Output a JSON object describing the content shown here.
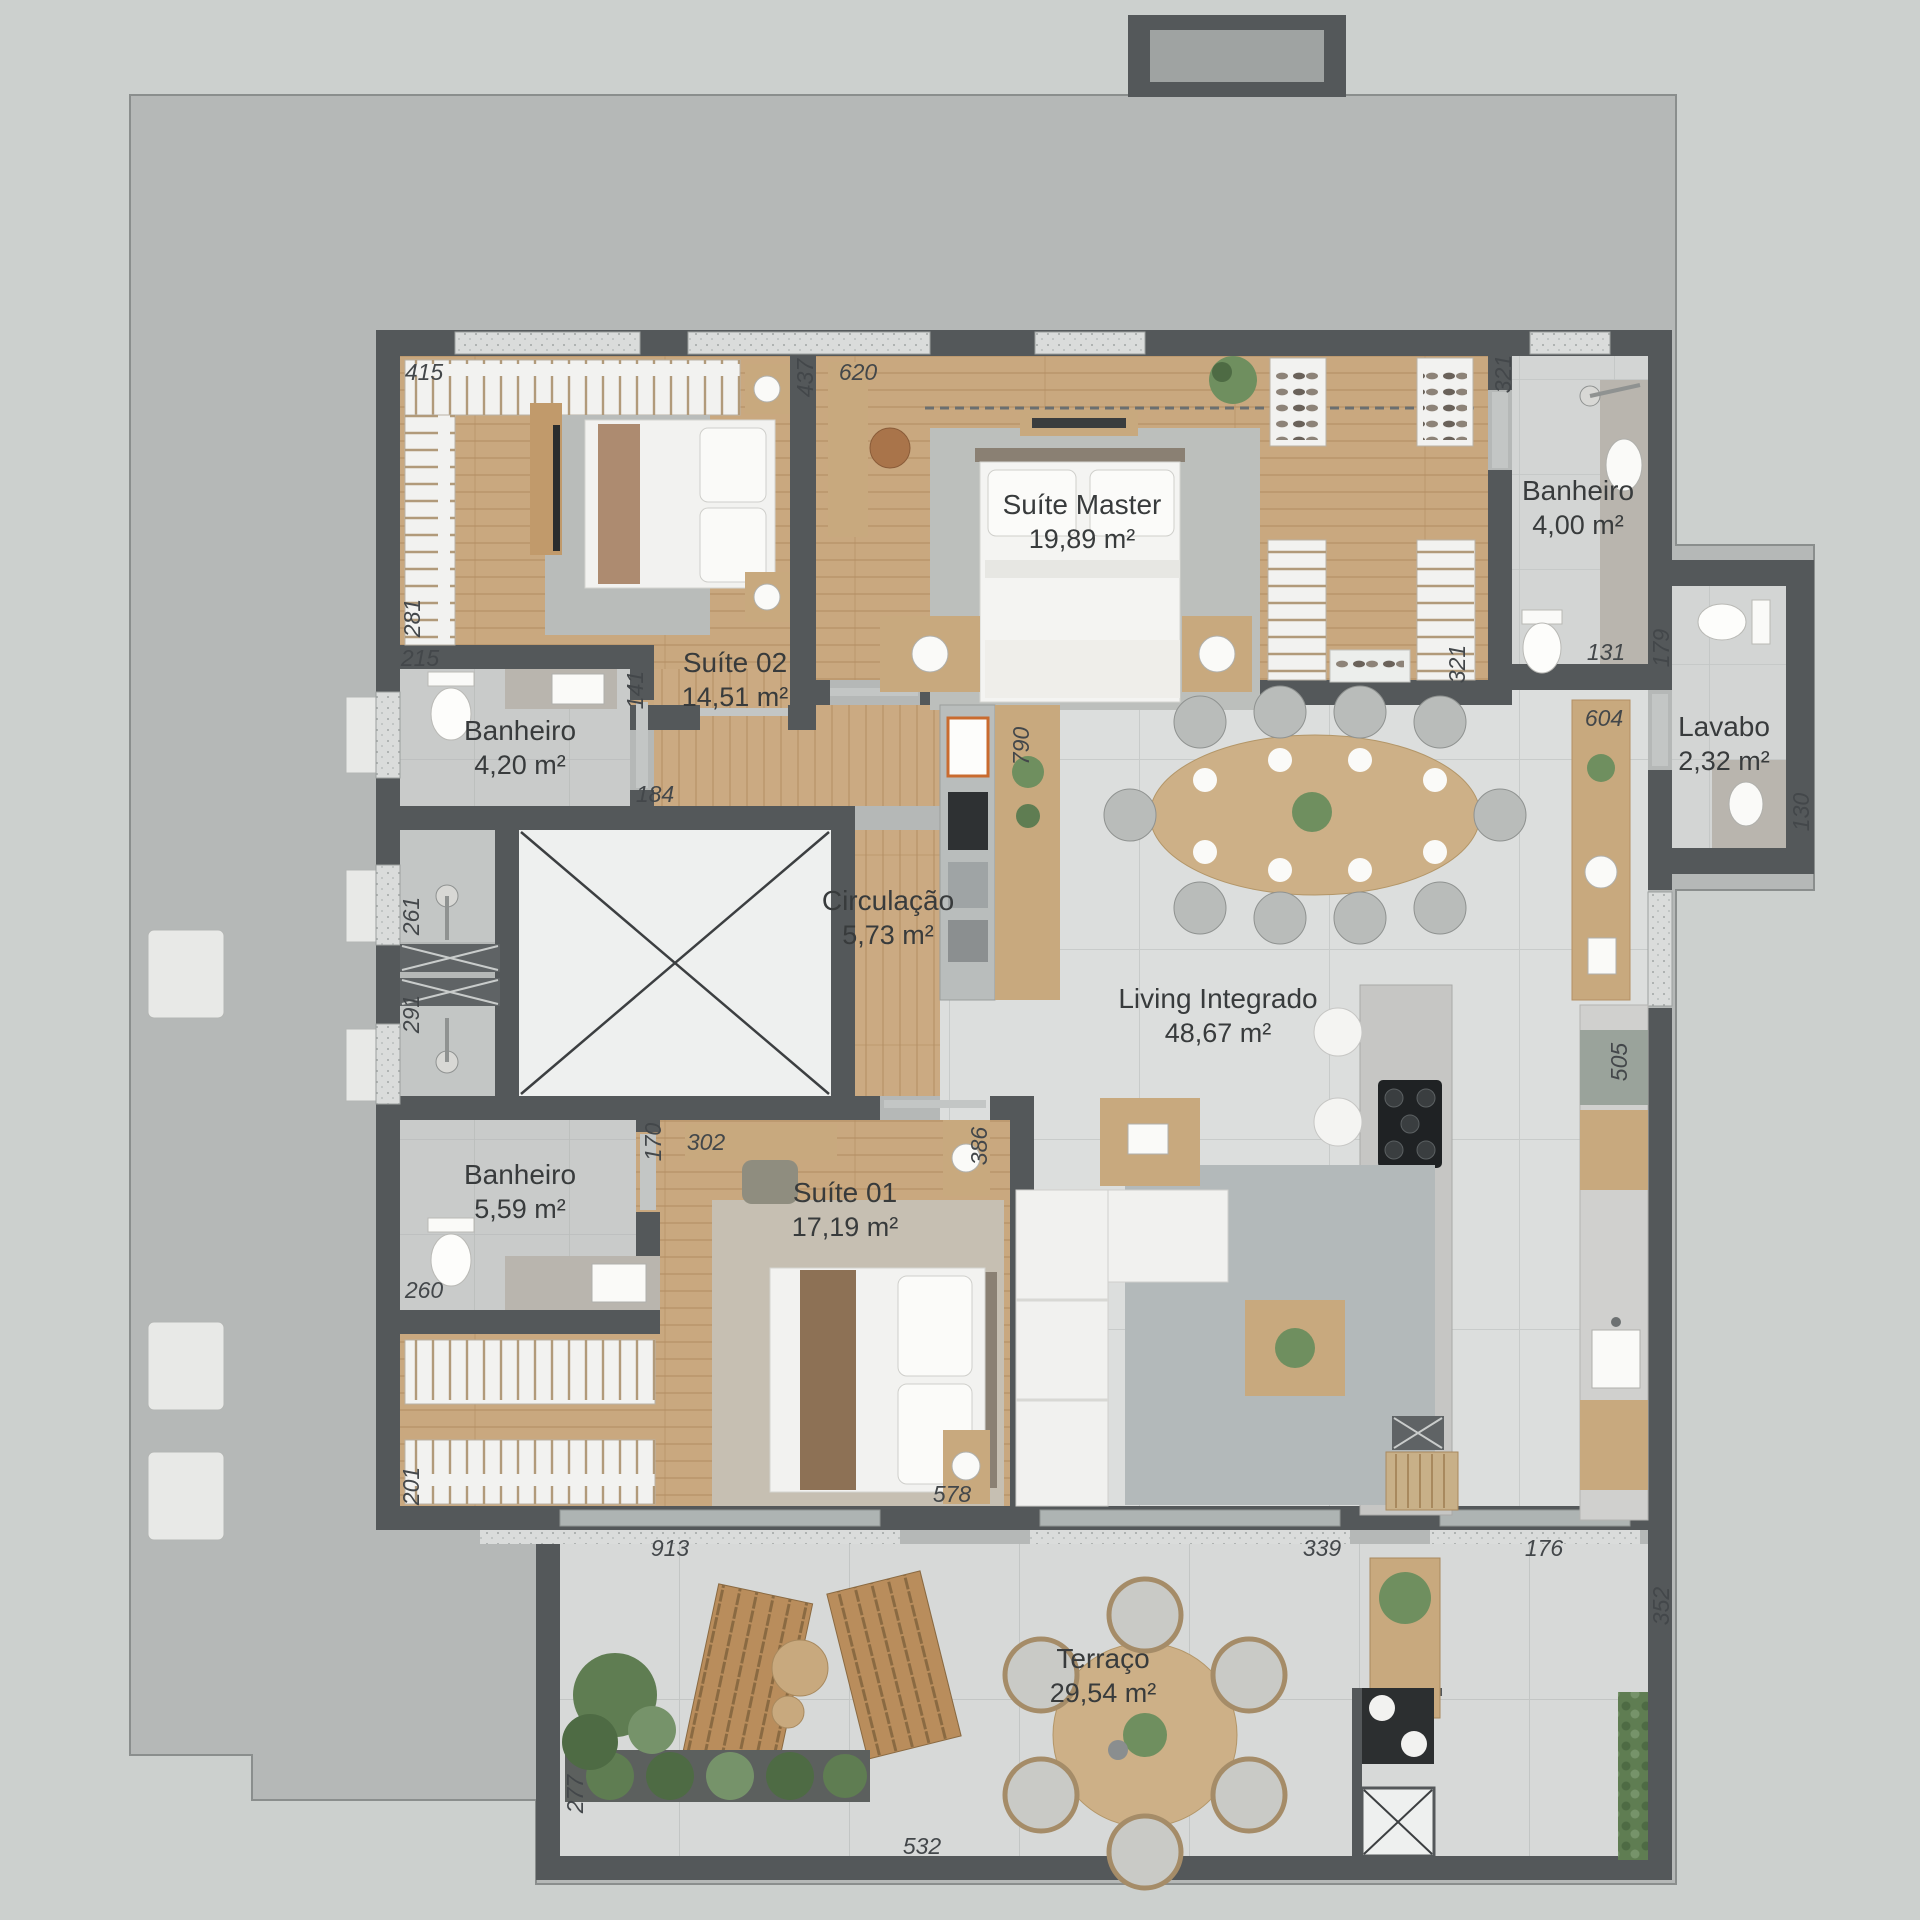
{
  "plan": {
    "rooms": {
      "suite02": {
        "name": "Suíte 02",
        "area": "14,51 m²"
      },
      "suiteMaster": {
        "name": "Suíte Master",
        "area": "19,89 m²"
      },
      "banheiroMaster": {
        "name": "Banheiro",
        "area": "4,00 m²"
      },
      "banheiroSuite02": {
        "name": "Banheiro",
        "area": "4,20 m²"
      },
      "lavabo": {
        "name": "Lavabo",
        "area": "2,32 m²"
      },
      "circulacao": {
        "name": "Circulação",
        "area": "5,73 m²"
      },
      "living": {
        "name": "Living Integrado",
        "area": "48,67 m²"
      },
      "banheiroSuite01": {
        "name": "Banheiro",
        "area": "5,59 m²"
      },
      "suite01": {
        "name": "Suíte 01",
        "area": "17,19 m²"
      },
      "terraco": {
        "name": "Terraço",
        "area": "29,54 m²"
      }
    },
    "dims": {
      "d415": "415",
      "d281": "281",
      "d437": "437",
      "d620": "620",
      "d321a": "321",
      "d321b": "321",
      "d215": "215",
      "d141": "141",
      "d184": "184",
      "d131": "131",
      "d179": "179",
      "d604": "604",
      "d130": "130",
      "d790": "790",
      "d261": "261",
      "d291": "291",
      "d170": "170",
      "d302": "302",
      "d386": "386",
      "d505": "505",
      "d260": "260",
      "d201": "201",
      "d578": "578",
      "d913": "913",
      "d339": "339",
      "d176": "176",
      "d352": "352",
      "d277": "277",
      "d532": "532"
    },
    "palette": {
      "wall": "#54585a",
      "slab": "#b5b8b7",
      "wood": "#c9a87f",
      "tile": "#dcdedd",
      "bath": "#c9cbca",
      "white": "#f2f2f0",
      "marble": "#b9b5ae",
      "green": "#5f7d52",
      "cabinetWood": "#c8a97e",
      "text": "#383b3c"
    }
  }
}
